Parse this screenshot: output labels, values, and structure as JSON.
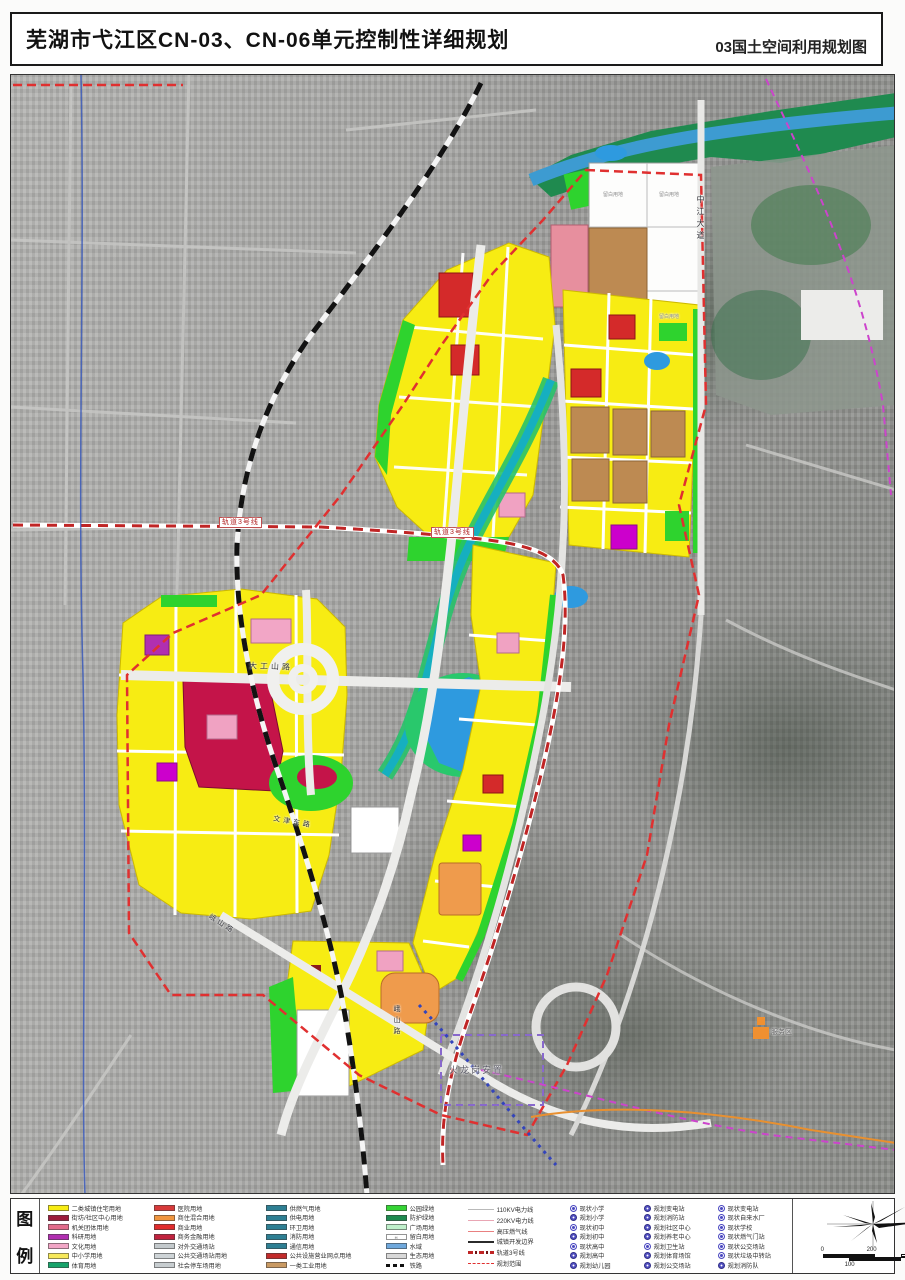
{
  "title": {
    "main": "芜湖市弋江区CN-03、CN-06单元控制性详细规划",
    "right": "03国土空间利用规划图"
  },
  "legend": {
    "heading_top": "图",
    "heading_bottom": "例",
    "landuse_columns": [
      [
        {
          "color": "#f7ec13",
          "label": "二类城镇住宅用地"
        },
        {
          "color": "#9c1c3c",
          "label": "街坊/社区中心用地"
        },
        {
          "color": "#e26b8b",
          "label": "机关团体用地"
        },
        {
          "color": "#b12fb1",
          "label": "科研用地"
        },
        {
          "color": "#f2a6c6",
          "label": "文化用地"
        },
        {
          "color": "#f7e95a",
          "label": "中小学用地"
        },
        {
          "color": "#17a46b",
          "label": "体育用地"
        }
      ],
      [
        {
          "color": "#d73a3a",
          "label": "医院用地"
        },
        {
          "color": "#f0953f",
          "label": "商住混合用地"
        },
        {
          "color": "#e02c2c",
          "label": "商业用地"
        },
        {
          "color": "#c0233e",
          "label": "商务金融用地"
        },
        {
          "color": "#c3c9cc",
          "label": "对外交通场站"
        },
        {
          "color": "#ced4d7",
          "label": "公共交通场站用地"
        },
        {
          "color": "#c7cdd0",
          "label": "社会停车场用地"
        }
      ],
      [
        {
          "color": "#2e7f93",
          "label": "供燃气用地"
        },
        {
          "color": "#2e7f93",
          "label": "供电用地"
        },
        {
          "color": "#2e7f93",
          "label": "环卫用地"
        },
        {
          "color": "#2e7f93",
          "label": "消防用地"
        },
        {
          "color": "#2e7f93",
          "label": "通信用地"
        },
        {
          "color": "#c22b2b",
          "label": "公共设施营业网点用地"
        },
        {
          "color": "#c99a63",
          "label": "一类工业用地"
        }
      ],
      [
        {
          "color": "#35d435",
          "label": "公园绿地"
        },
        {
          "color": "#1e8a4f",
          "label": "防护绿地"
        },
        {
          "color": "#bff0cb",
          "label": "广场用地"
        },
        {
          "color": "#ffffff",
          "label": "留白用地",
          "mark": "H"
        },
        {
          "color": "#6fa8dc",
          "label": "水域"
        },
        {
          "color": "#d8d8d8",
          "label": "生态用地"
        },
        {
          "swatch": "dash",
          "label": "铁路"
        }
      ]
    ],
    "lines": [
      {
        "cls": "d1",
        "label": "110KV电力线"
      },
      {
        "cls": "d2",
        "label": "220KV电力线"
      },
      {
        "cls": "d3",
        "label": "高压燃气线"
      },
      {
        "cls": "d4",
        "label": "城镇开发边界"
      },
      {
        "cls": "d5",
        "label": "轨道3号线"
      },
      {
        "cls": "d6",
        "label": "规划范围"
      }
    ],
    "facilities_columns": [
      [
        {
          "type": "existing",
          "label": "现状小学"
        },
        {
          "type": "planned",
          "label": "规划小学"
        },
        {
          "type": "existing",
          "label": "现状初中"
        },
        {
          "type": "planned",
          "label": "规划初中"
        },
        {
          "type": "existing",
          "label": "现状高中"
        },
        {
          "type": "planned",
          "label": "规划高中"
        },
        {
          "type": "planned",
          "label": "规划幼儿园"
        }
      ],
      [
        {
          "type": "planned",
          "label": "规划变电站"
        },
        {
          "type": "planned",
          "label": "规划消防站"
        },
        {
          "type": "planned",
          "label": "规划社区中心"
        },
        {
          "type": "planned",
          "label": "规划养老中心"
        },
        {
          "type": "existing",
          "label": "规划卫生站"
        },
        {
          "type": "planned",
          "label": "规划体育场馆"
        },
        {
          "type": "planned",
          "label": "规划公交场站"
        }
      ],
      [
        {
          "type": "existing",
          "label": "现状变电站"
        },
        {
          "type": "existing",
          "label": "现状自来水厂"
        },
        {
          "type": "existing",
          "label": "现状学校"
        },
        {
          "type": "existing",
          "label": "现状燃气门站"
        },
        {
          "type": "existing",
          "label": "现状公交场站"
        },
        {
          "type": "existing",
          "label": "现状垃圾中转站"
        },
        {
          "type": "planned",
          "label": "规划消防队"
        }
      ]
    ],
    "scalebar": {
      "zero": "0",
      "two_hundred": "200",
      "one_hundred": "100",
      "four_hundred": "400M"
    }
  },
  "map_labels": {
    "rail3_a": "轨道3号线",
    "rail3_b": "轨道3号线",
    "dagongshan": "大工山路",
    "wenjin": "文津东路",
    "eshan_a": "峨山路",
    "eshan_b": "峨山路",
    "zhongjiang": "中江大道",
    "liubai_1": "留白用地",
    "liubai_2": "留白用地",
    "liubai_3": "留白用地",
    "huolonggang": "火龙岗安置",
    "service": "服务区"
  }
}
